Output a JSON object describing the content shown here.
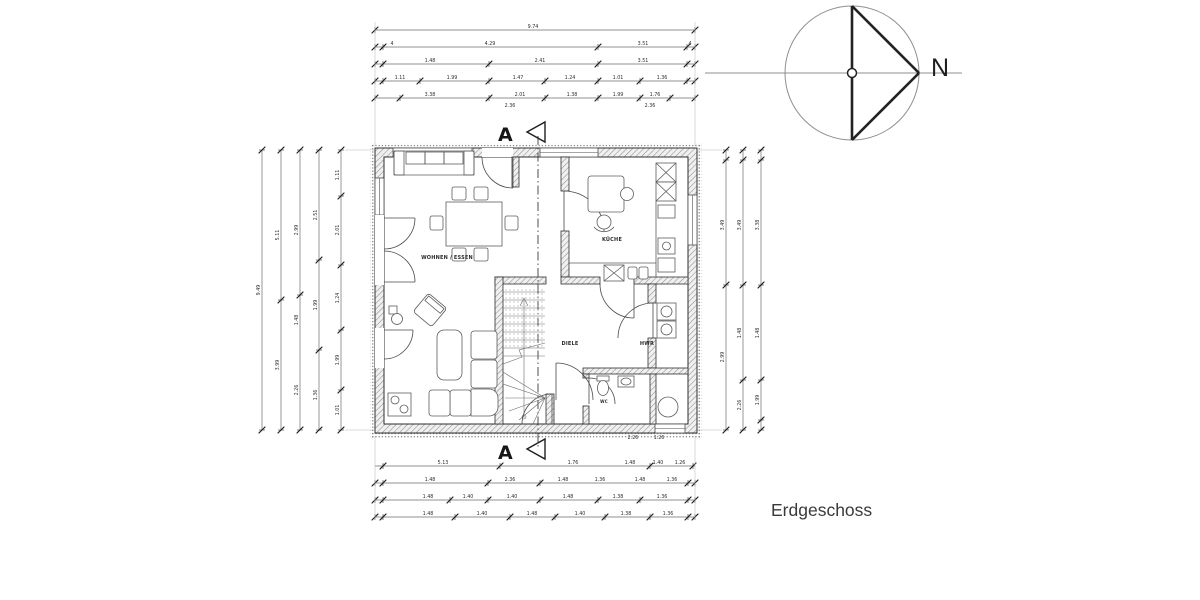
{
  "page": {
    "title": "Erdgeschoss"
  },
  "compass": {
    "label": "N"
  },
  "section": {
    "marker": "A"
  },
  "rooms": {
    "wohnen": "WOHNEN / ESSEN",
    "kueche": "KÜCHE",
    "diele": "DIELE",
    "hwr": "HWR",
    "wc": "WC"
  },
  "colors": {
    "ink": "#2e2e2e",
    "light_line": "#8f8f8f",
    "paper": "#ffffff"
  },
  "dimensions": {
    "h_rows": [
      {
        "y": 30,
        "x1": 375,
        "x2": 695,
        "ticks": [
          375,
          695
        ],
        "labels": [
          {
            "x": 533,
            "t": "9.74"
          }
        ]
      },
      {
        "y": 47,
        "x1": 375,
        "x2": 695,
        "ticks": [
          375,
          383,
          598,
          687,
          695
        ],
        "labels": [
          {
            "x": 392,
            "t": "4"
          },
          {
            "x": 490,
            "t": "4.29"
          },
          {
            "x": 643,
            "t": "3.51"
          },
          {
            "x": 690,
            "t": "4"
          }
        ]
      },
      {
        "y": 64,
        "x1": 375,
        "x2": 695,
        "ticks": [
          375,
          383,
          489,
          598,
          687,
          695
        ],
        "labels": [
          {
            "x": 430,
            "t": "1.48"
          },
          {
            "x": 540,
            "t": "2.41"
          },
          {
            "x": 643,
            "t": "3.51"
          }
        ]
      },
      {
        "y": 81,
        "x1": 375,
        "x2": 695,
        "ticks": [
          375,
          383,
          420,
          489,
          545,
          598,
          640,
          687,
          695
        ],
        "labels": [
          {
            "x": 400,
            "t": "1.11"
          },
          {
            "x": 452,
            "t": "1.99"
          },
          {
            "x": 518,
            "t": "1.47"
          },
          {
            "x": 570,
            "t": "1.24"
          },
          {
            "x": 618,
            "t": "1.01"
          },
          {
            "x": 662,
            "t": "1.36"
          }
        ]
      },
      {
        "y": 98,
        "x1": 375,
        "x2": 695,
        "ticks": [
          375,
          400,
          489,
          545,
          598,
          640,
          670,
          695
        ],
        "labels": [
          {
            "x": 430,
            "t": "3.38"
          },
          {
            "x": 520,
            "t": "2.01"
          },
          {
            "x": 572,
            "t": "1.38"
          },
          {
            "x": 618,
            "t": "1.99"
          },
          {
            "x": 655,
            "t": "1.76"
          }
        ]
      },
      {
        "y": 109,
        "x1": 375,
        "x2": 695,
        "line": false,
        "ticks": [],
        "labels": [
          {
            "x": 510,
            "t": "2.36"
          },
          {
            "x": 650,
            "t": "2.36"
          }
        ]
      },
      {
        "y": 441,
        "x1": 375,
        "x2": 695,
        "line": false,
        "ticks": [],
        "labels": [
          {
            "x": 633,
            "t": "2.26"
          },
          {
            "x": 659,
            "t": "1.26"
          }
        ]
      },
      {
        "y": 466,
        "x1": 375,
        "x2": 695,
        "ticks": [
          383,
          500,
          650,
          693
        ],
        "labels": [
          {
            "x": 443,
            "t": "5.13"
          },
          {
            "x": 573,
            "t": "1.76"
          },
          {
            "x": 630,
            "t": "1.48"
          },
          {
            "x": 658,
            "t": "1.40"
          },
          {
            "x": 680,
            "t": "1.26"
          }
        ]
      },
      {
        "y": 483,
        "x1": 375,
        "x2": 695,
        "ticks": [
          375,
          383,
          488,
          540,
          688,
          695
        ],
        "labels": [
          {
            "x": 430,
            "t": "1.48"
          },
          {
            "x": 510,
            "t": "2.36"
          },
          {
            "x": 563,
            "t": "1.48"
          },
          {
            "x": 600,
            "t": "1.36"
          },
          {
            "x": 640,
            "t": "1.48"
          },
          {
            "x": 672,
            "t": "1.36"
          }
        ]
      },
      {
        "y": 500,
        "x1": 375,
        "x2": 695,
        "ticks": [
          375,
          383,
          450,
          488,
          540,
          598,
          640,
          688,
          695
        ],
        "labels": [
          {
            "x": 428,
            "t": "1.48"
          },
          {
            "x": 468,
            "t": "1.40"
          },
          {
            "x": 512,
            "t": "1.40"
          },
          {
            "x": 568,
            "t": "1.48"
          },
          {
            "x": 618,
            "t": "1.38"
          },
          {
            "x": 662,
            "t": "1.36"
          }
        ]
      },
      {
        "y": 517,
        "x1": 375,
        "x2": 695,
        "ticks": [
          375,
          383,
          455,
          510,
          555,
          605,
          650,
          688,
          695
        ],
        "labels": [
          {
            "x": 428,
            "t": "1.48"
          },
          {
            "x": 482,
            "t": "1.40"
          },
          {
            "x": 532,
            "t": "1.48"
          },
          {
            "x": 580,
            "t": "1.40"
          },
          {
            "x": 626,
            "t": "1.38"
          },
          {
            "x": 668,
            "t": "1.36"
          }
        ]
      }
    ],
    "v_cols": [
      {
        "x": 262,
        "y1": 150,
        "y2": 430,
        "ticks": [
          150,
          430
        ],
        "labels": [
          {
            "y": 290,
            "t": "9.49"
          }
        ]
      },
      {
        "x": 281,
        "y1": 150,
        "y2": 430,
        "ticks": [
          150,
          300,
          430
        ],
        "labels": [
          {
            "y": 235,
            "t": "5.11"
          },
          {
            "y": 365,
            "t": "3.99"
          }
        ]
      },
      {
        "x": 300,
        "y1": 150,
        "y2": 430,
        "ticks": [
          150,
          295,
          430
        ],
        "labels": [
          {
            "y": 230,
            "t": "2.99"
          },
          {
            "y": 320,
            "t": "1.48"
          },
          {
            "y": 390,
            "t": "2.26"
          }
        ]
      },
      {
        "x": 319,
        "y1": 150,
        "y2": 430,
        "ticks": [
          150,
          260,
          350,
          430
        ],
        "labels": [
          {
            "y": 215,
            "t": "2.51"
          },
          {
            "y": 305,
            "t": "1.99"
          },
          {
            "y": 395,
            "t": "1.36"
          }
        ]
      },
      {
        "x": 341,
        "y1": 150,
        "y2": 430,
        "ticks": [
          150,
          196,
          265,
          330,
          390,
          430
        ],
        "labels": [
          {
            "y": 175,
            "t": "1.11"
          },
          {
            "y": 230,
            "t": "2.01"
          },
          {
            "y": 298,
            "t": "1.24"
          },
          {
            "y": 360,
            "t": "1.99"
          },
          {
            "y": 410,
            "t": "1.01"
          }
        ]
      },
      {
        "x": 726,
        "y1": 150,
        "y2": 430,
        "ticks": [
          150,
          160,
          285,
          430
        ],
        "labels": [
          {
            "y": 225,
            "t": "3.49"
          },
          {
            "y": 357,
            "t": "2.99"
          }
        ]
      },
      {
        "x": 743,
        "y1": 150,
        "y2": 430,
        "ticks": [
          150,
          160,
          285,
          380,
          430
        ],
        "labels": [
          {
            "y": 225,
            "t": "3.49"
          },
          {
            "y": 333,
            "t": "1.48"
          },
          {
            "y": 405,
            "t": "2.26"
          }
        ]
      },
      {
        "x": 761,
        "y1": 150,
        "y2": 430,
        "ticks": [
          150,
          160,
          285,
          380,
          420,
          430
        ],
        "labels": [
          {
            "y": 225,
            "t": "3.38"
          },
          {
            "y": 333,
            "t": "1.48"
          },
          {
            "y": 400,
            "t": "1.99"
          }
        ]
      }
    ]
  }
}
